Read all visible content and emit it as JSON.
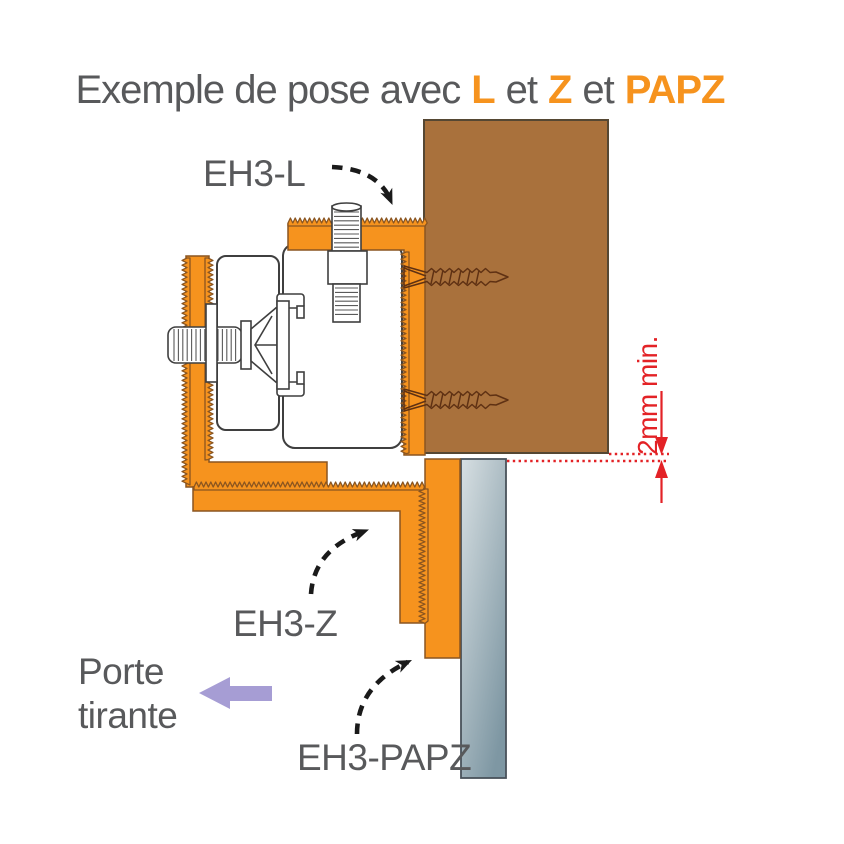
{
  "title": {
    "prefix": "Exemple de pose avec",
    "item1": "L",
    "sep1": "et",
    "item2": "Z",
    "sep2": "et",
    "item3": "PAPZ"
  },
  "labels": {
    "bracket_l": "EH3-L",
    "bracket_z": "EH3-Z",
    "plate_papz": "EH3-PAPZ",
    "door_line1": "Porte",
    "door_line2": "tirante",
    "min_gap": "2mm min."
  },
  "colors": {
    "orange": "#F6931E",
    "orange_outline": "#8A5520",
    "wood": "#A9713C",
    "wood_outline": "#554733",
    "panel_light": "#D7DFE2",
    "panel_dark": "#7E97A3",
    "panel_outline": "#49525A",
    "outline_dark": "#3F3F3F",
    "thread_gray": "#5A5A5A",
    "screw_outline": "#5F3113",
    "red": "#E32226",
    "purple": "#A69DD4",
    "text_gray": "#58595B",
    "arrow_black": "#1A1A1A"
  }
}
